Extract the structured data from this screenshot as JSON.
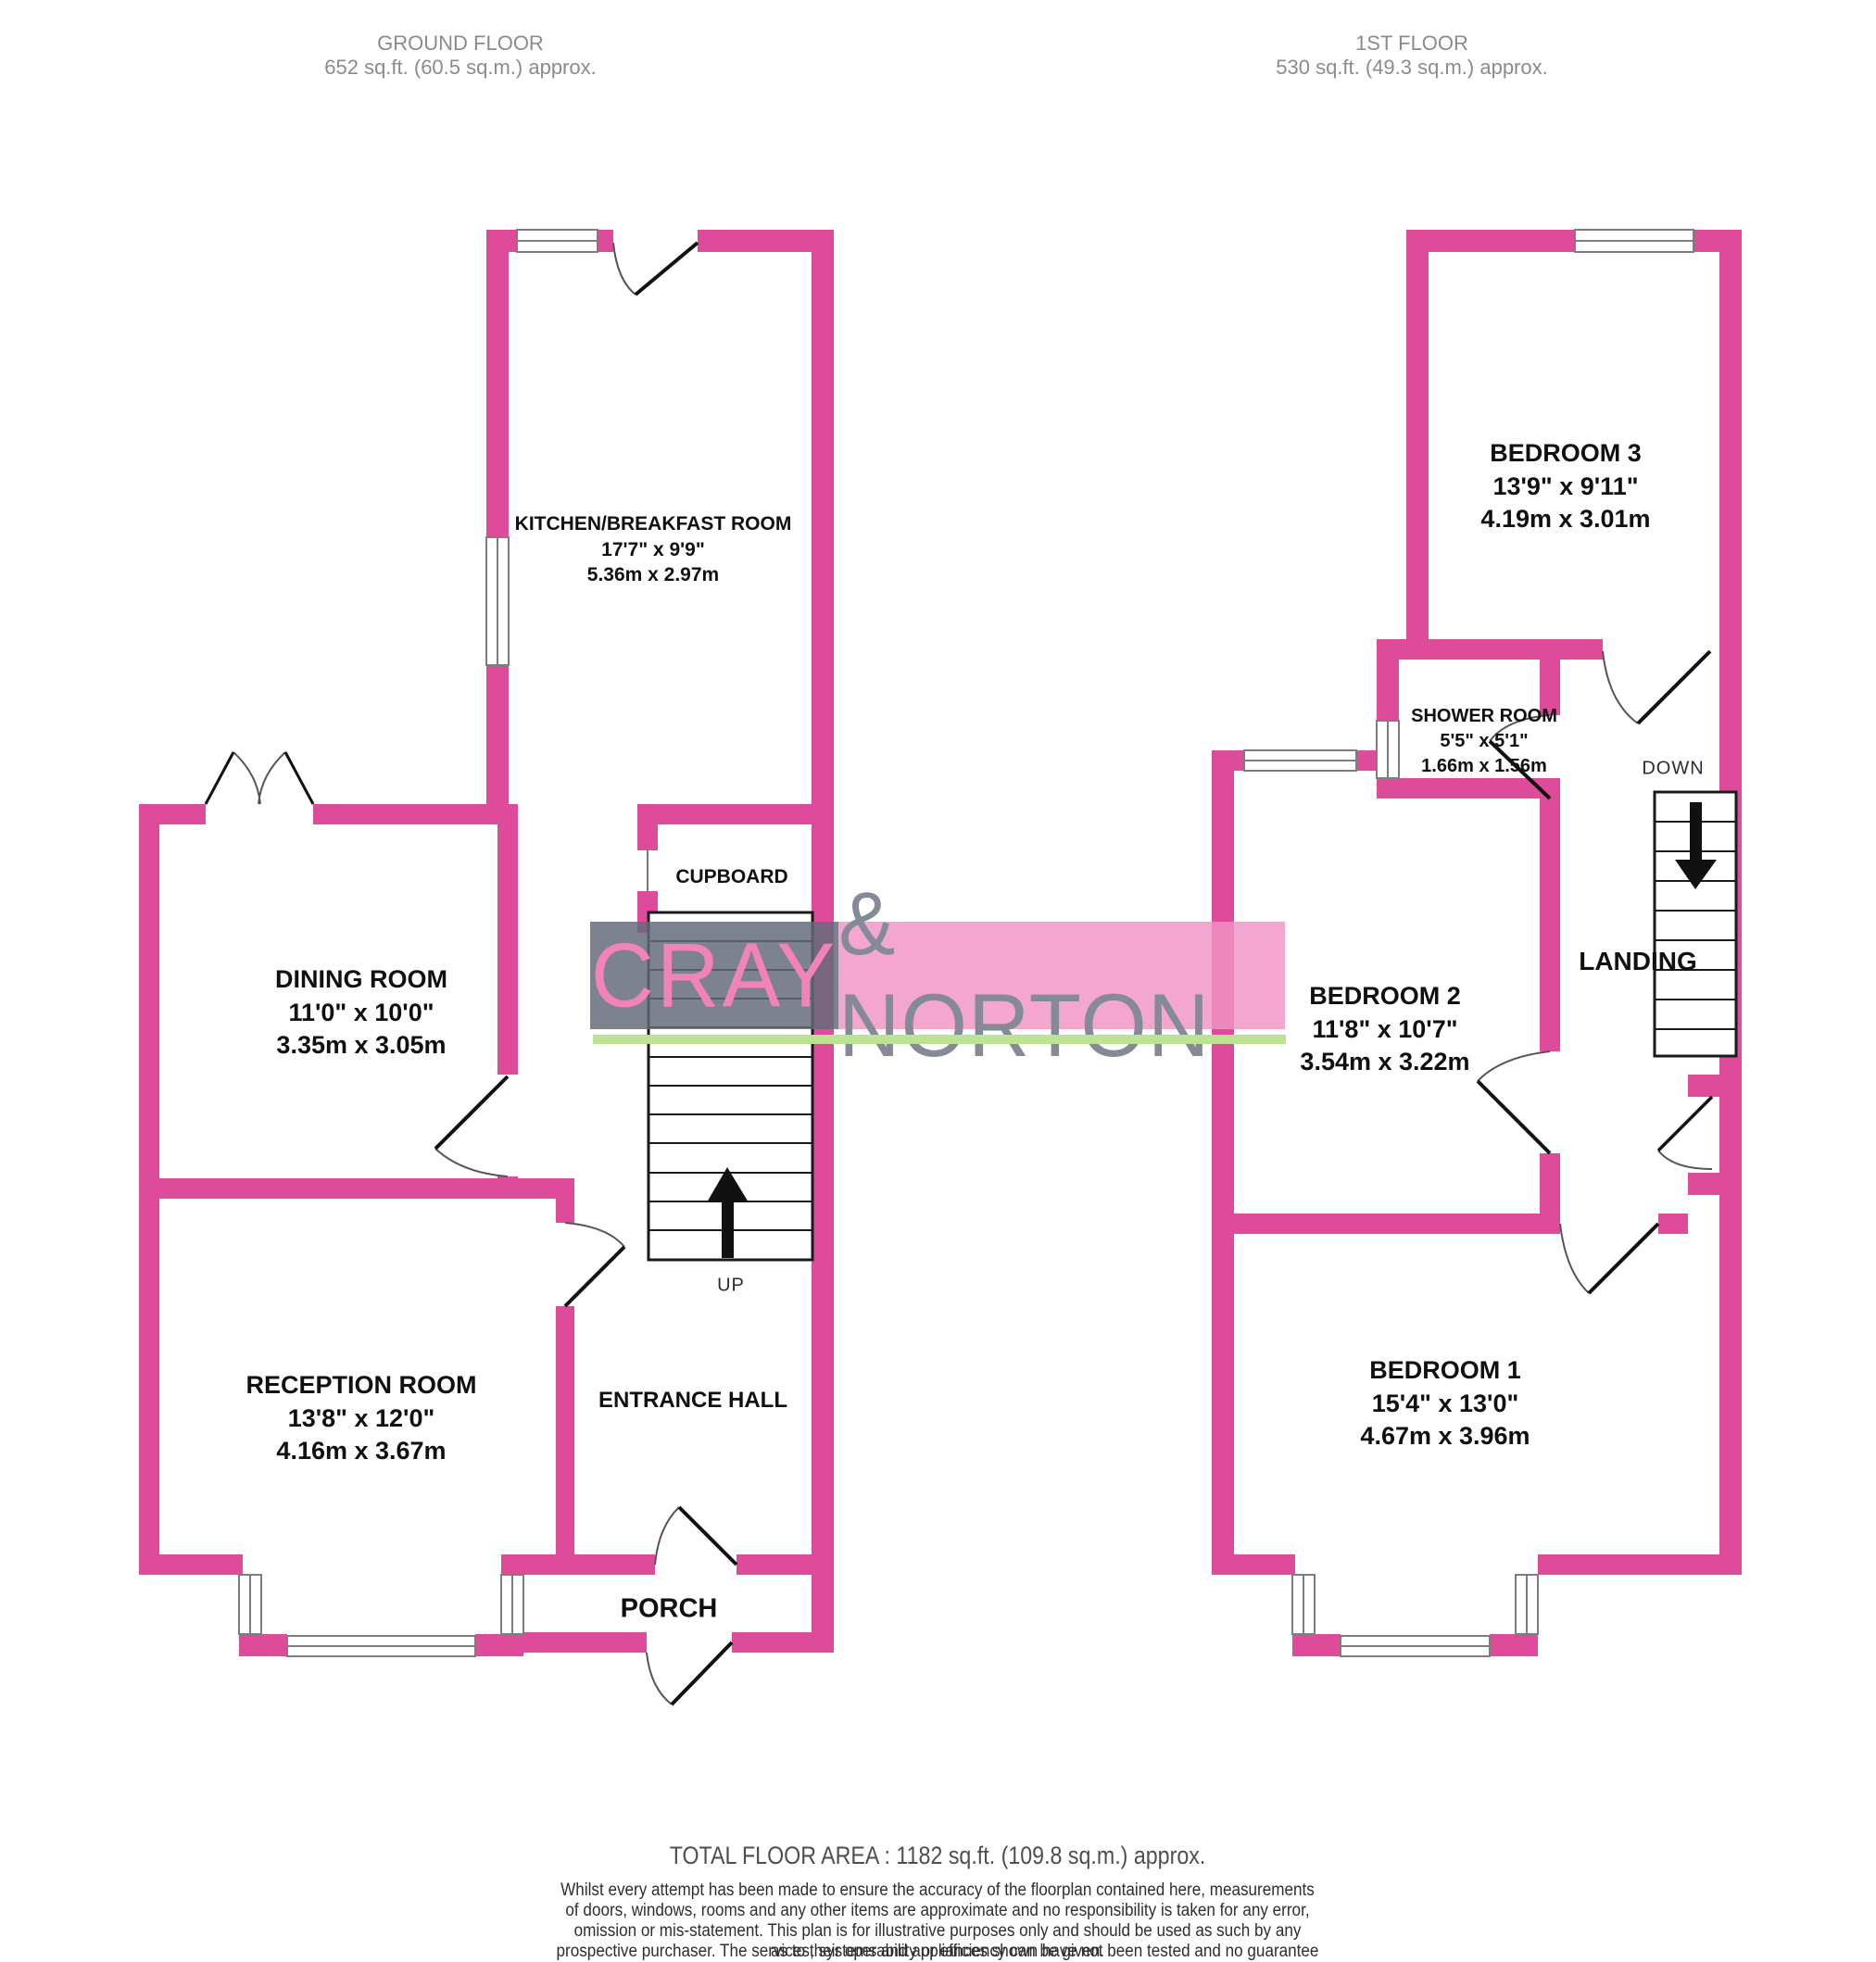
{
  "headers": {
    "ground": {
      "title": "GROUND FLOOR",
      "area": "652 sq.ft. (60.5 sq.m.) approx."
    },
    "first": {
      "title": "1ST FLOOR",
      "area": "530 sq.ft. (49.3 sq.m.) approx."
    }
  },
  "rooms": {
    "kitchen": {
      "name": "KITCHEN/BREAKFAST ROOM",
      "imperial": "17'7\"  x 9'9\"",
      "metric": "5.36m  x 2.97m"
    },
    "dining": {
      "name": "DINING ROOM",
      "imperial": "11'0\"  x 10'0\"",
      "metric": "3.35m  x 3.05m"
    },
    "reception": {
      "name": "RECEPTION ROOM",
      "imperial": "13'8\"  x 12'0\"",
      "metric": "4.16m  x 3.67m"
    },
    "bedroom3": {
      "name": "BEDROOM 3",
      "imperial": "13'9\"  x 9'11\"",
      "metric": "4.19m  x 3.01m"
    },
    "shower": {
      "name": "SHOWER ROOM",
      "imperial": "5'5\"  x 5'1\"",
      "metric": "1.66m  x 1.56m"
    },
    "bedroom2": {
      "name": "BEDROOM 2",
      "imperial": "11'8\"  x 10'7\"",
      "metric": "3.54m  x 3.22m"
    },
    "bedroom1": {
      "name": "BEDROOM 1",
      "imperial": "15'4\"  x 13'0\"",
      "metric": "4.67m  x 3.96m"
    }
  },
  "labels": {
    "cupboard": "CUPBOARD",
    "entrance_hall": "ENTRANCE HALL",
    "porch": "PORCH",
    "landing": "LANDING",
    "up": "UP",
    "down": "DOWN"
  },
  "watermark": {
    "left_text": "CRAY",
    "right_text": "& NORTON",
    "accent_pink": "#f283b8",
    "accent_gray": "#848a97",
    "underline_green": "#bce294"
  },
  "footer": {
    "total": "TOTAL FLOOR AREA : 1182 sq.ft. (109.8 sq.m.) approx.",
    "disclaimer": [
      "Whilst every attempt has been made to ensure the accuracy of the floorplan contained here, measurements",
      "of doors, windows, rooms and any other items are approximate and no responsibility is taken for any error,",
      "omission or mis-statement. This plan is for illustrative purposes only and should be used as such by any",
      "prospective purchaser. The services, systems and appliances shown have not been tested and no guarantee",
      "as to their operability or efficiency can be given."
    ],
    "credit": "Made with Metropix ©2026"
  },
  "colors": {
    "wall": "#de4b9b",
    "window_frame": "#7d7d7d",
    "stair_line": "#1a1a1a",
    "door_leaf": "#111111",
    "door_arc": "#555555"
  }
}
